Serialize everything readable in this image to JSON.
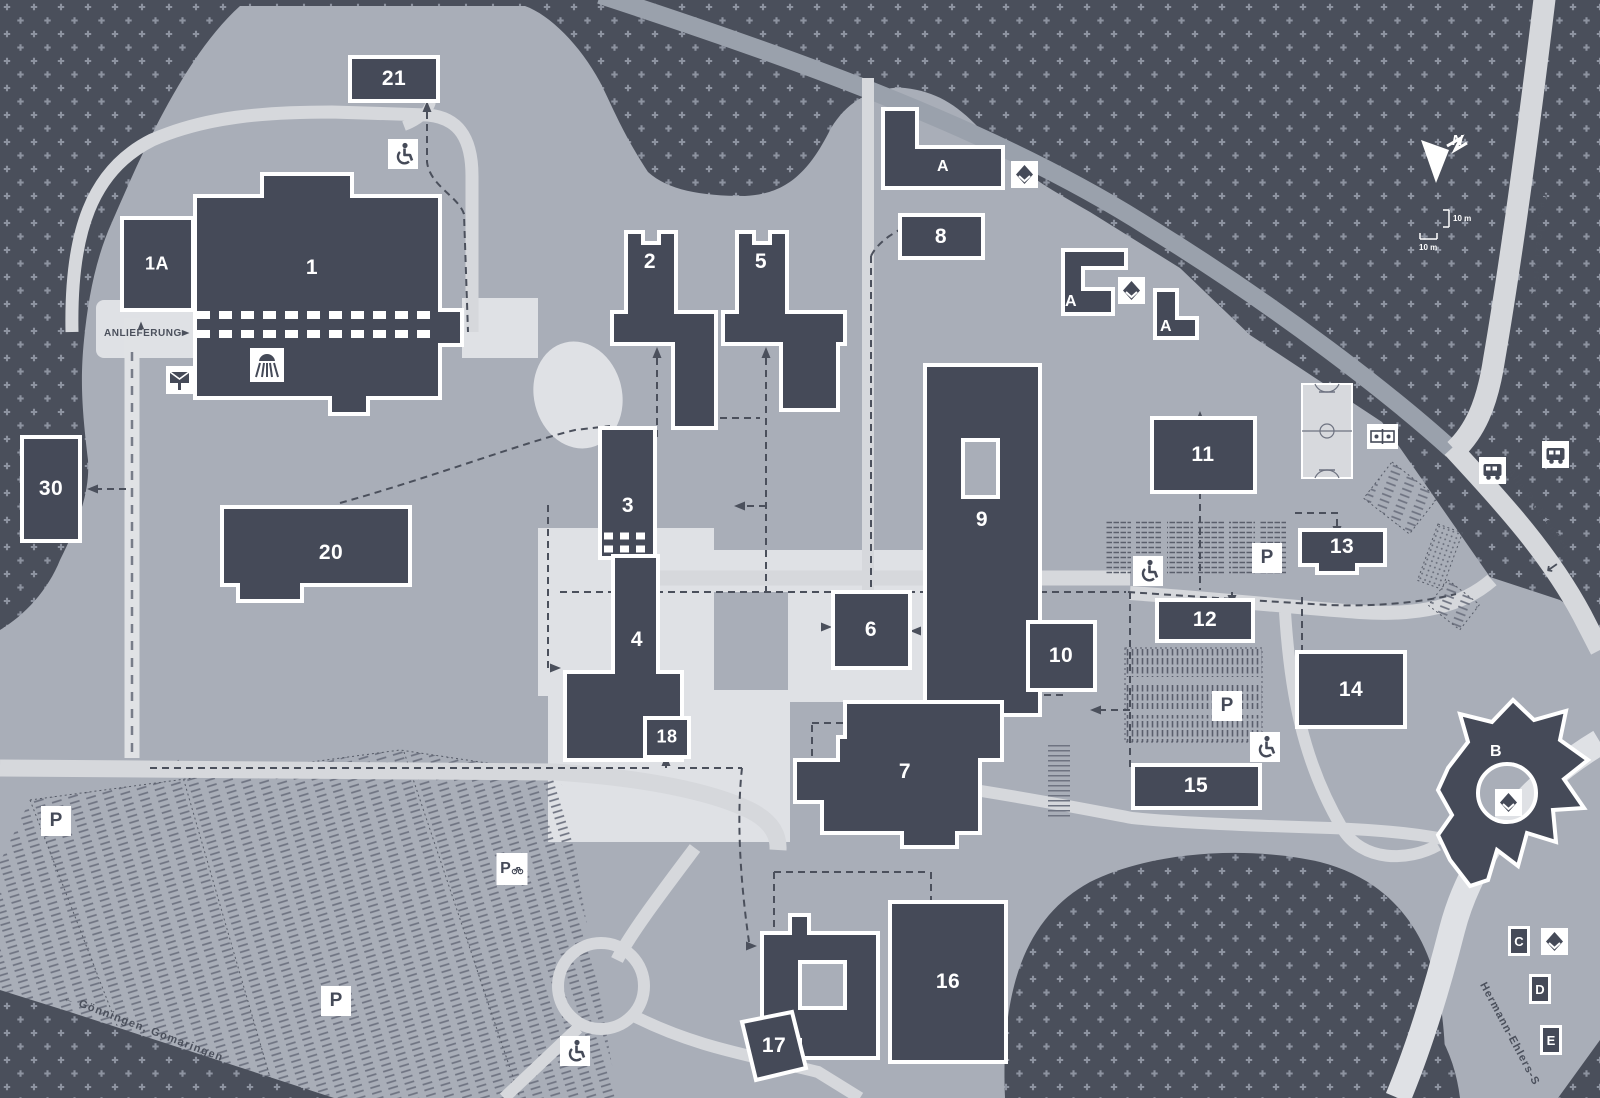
{
  "map": {
    "kind": "campus-site-plan",
    "colors": {
      "background": "#4a4f5b",
      "dot_grid": "#8d93a0",
      "campus_ground": "#a9aeb8",
      "building_fill": "#454a58",
      "building_outline": "#ffffff",
      "road_light": "#d6d8dc",
      "road_secondary": "#9aa1ac",
      "path_dash": "#4b505c"
    },
    "buildings": {
      "b1": "1",
      "b1a": "1A",
      "b2": "2",
      "b3": "3",
      "b4": "4",
      "b5": "5",
      "b6": "6",
      "b7": "7",
      "b8": "8",
      "b9": "9",
      "b10": "10",
      "b11": "11",
      "b12": "12",
      "b13": "13",
      "b14": "14",
      "b15": "15",
      "b16": "16",
      "b17": "17",
      "b18": "18",
      "b20": "20",
      "b21": "21",
      "b30": "30"
    },
    "areas": {
      "a": "A",
      "b": "B",
      "c": "C",
      "d": "D",
      "e": "E"
    },
    "parking": {
      "p": "P"
    },
    "streets": {
      "pestalozzistrasse": "Pestalozzistraße",
      "alle_richtungen": "Alle Richtungen",
      "alle_richtungen_arrow": "↙",
      "hermann_ehlers": "Hermann-Ehlers-S",
      "goenningen": "← Gönningen, Gomaringen",
      "anlieferung": "ANLIEFERUNG"
    },
    "compass": {
      "north": "N"
    },
    "scale": {
      "label1": "10 m",
      "label2": "10 m"
    },
    "icons": {
      "wheelchair-icon": "wheelchair accessible entrance",
      "mailbox-icon": "letter box",
      "artwork-icon": "artwork / sculpture marker",
      "bus-icon": "bus stop",
      "table-tennis-icon": "table tennis",
      "auditorium-icon": "lecture hall",
      "bicycle-icon": "bicycle parking",
      "basketball-court": "sports court",
      "north-arrow": "north"
    }
  }
}
